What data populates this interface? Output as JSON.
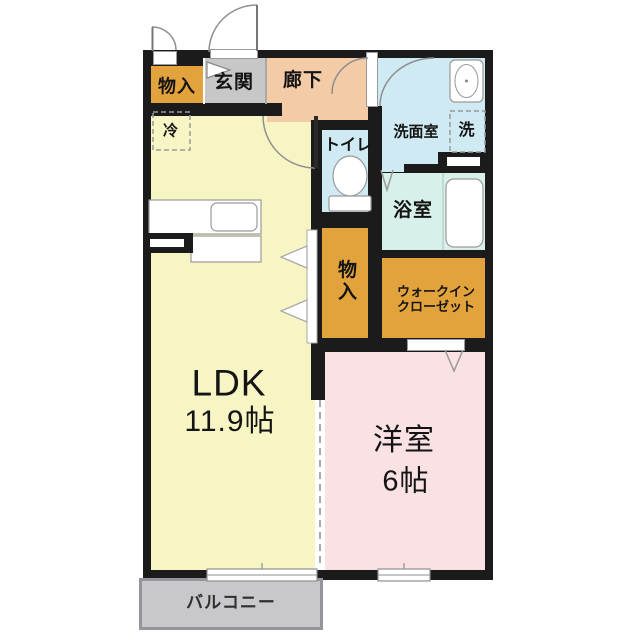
{
  "plan": {
    "type": "japanese-apartment-floor-plan",
    "rooms": {
      "storage_top": {
        "label": "物入"
      },
      "entrance": {
        "label": "玄関"
      },
      "hallway": {
        "label": "廊下"
      },
      "toilet": {
        "label": "トイレ"
      },
      "washroom": {
        "label": "洗面室"
      },
      "washer": {
        "label": "洗"
      },
      "refrigerator": {
        "label": "冷"
      },
      "bathroom": {
        "label": "浴室"
      },
      "storage_mid": {
        "line1": "物",
        "line2": "入"
      },
      "walk_in_closet": {
        "line1": "ウォークイン",
        "line2": "クローゼット"
      },
      "ldk": {
        "name": "LDK",
        "size": "11.9帖"
      },
      "western_room": {
        "name": "洋室",
        "size": "6帖"
      },
      "balcony": {
        "label": "バルコニー"
      }
    },
    "fixtures": [
      "entrance-door",
      "storage-exterior-door",
      "ldk-door",
      "washroom-door",
      "hallway-door",
      "kitchen-counter",
      "kitchen-sink",
      "refrigerator-space",
      "washing-machine-space",
      "washbasin",
      "toilet-bowl",
      "bathtub",
      "folding-door-bathroom",
      "folding-door-closet",
      "storage-folding-doors",
      "sliding-partition",
      "window-ldk",
      "window-western-room"
    ],
    "colors": {
      "wall": "#1b1b1b",
      "ldk": "#f8f5c4",
      "storage": "#e3a33c",
      "entrance": "#c7c7c7",
      "hallway": "#f3cba6",
      "wet_area": "#cfeaf2",
      "bathroom": "#d7f0e9",
      "western_room": "#f9e1e4",
      "balcony": "#c8c8ca",
      "fixture_stroke": "#8f8f8f"
    }
  }
}
